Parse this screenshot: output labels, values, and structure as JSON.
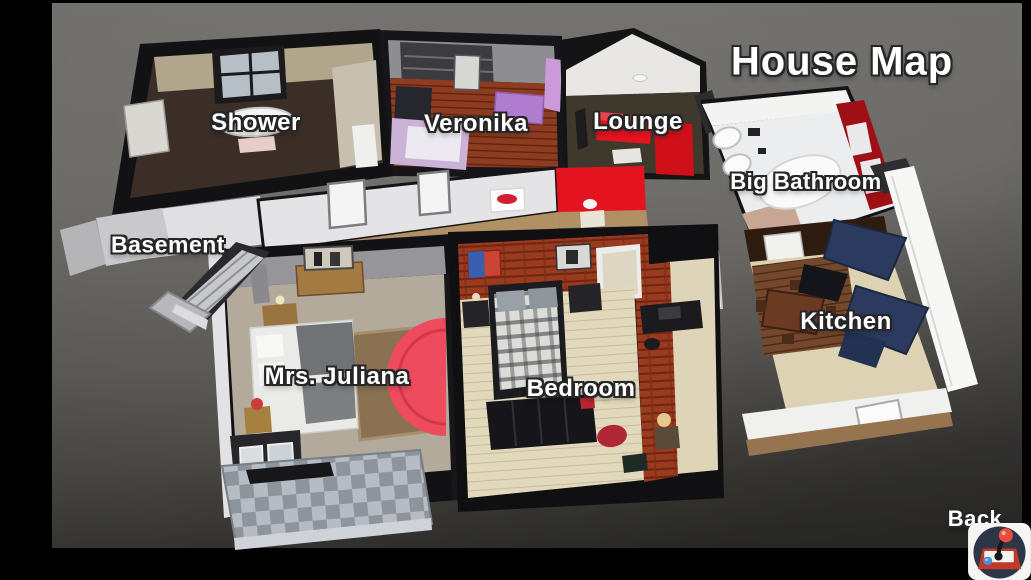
{
  "map": {
    "title": "House Map",
    "rooms": [
      {
        "id": "shower",
        "label": "Shower"
      },
      {
        "id": "veronika",
        "label": "Veronika"
      },
      {
        "id": "lounge",
        "label": "Lounge"
      },
      {
        "id": "big-bathroom",
        "label": "Big Bathroom"
      },
      {
        "id": "basement",
        "label": "Basement"
      },
      {
        "id": "kitchen",
        "label": "Kitchen"
      },
      {
        "id": "mrs-juliana",
        "label": "Mrs. Juliana"
      },
      {
        "id": "bedroom",
        "label": "Bedroom"
      }
    ]
  },
  "footer": {
    "back_label": "Back",
    "corner_icon_name": "arcade-joystick-icon"
  },
  "colors": {
    "letterbox": "#000000",
    "stage_gray": "#6a6966",
    "label_text": "#ffffff",
    "label_outline": "#262626",
    "accent_red": "#e31420",
    "brick_red": "#9a3a1e",
    "cabinet_navy": "#2b3a5e",
    "icon_base_red": "#c0392b",
    "icon_ball_red": "#e74c3c",
    "icon_button_blue": "#4a90d9",
    "icon_circle_navy": "#2d3547"
  }
}
